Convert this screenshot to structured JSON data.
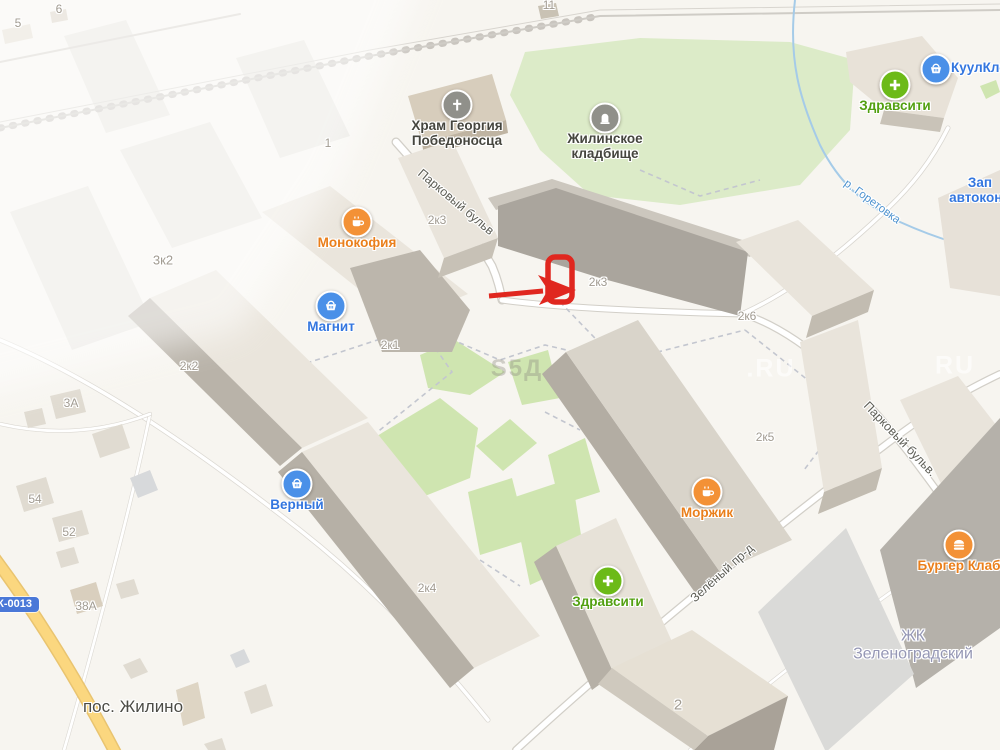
{
  "map": {
    "palette": {
      "land": "#f7f5f0",
      "green_courtyard": "#cfe5b0",
      "green_cemetery": "#dcebc8",
      "building_roof": "#eae5dc",
      "building_side_dark": "#b5afa5",
      "building_roof_dark": "#aaa59d",
      "poi_blue": "#3376df",
      "poi_orange": "#ea7f1b",
      "poi_green": "#53a011",
      "poi_gray": "#90908a",
      "annotation_red": "#e0271f",
      "river_blue": "#4f93cf"
    },
    "pois": [
      {
        "id": "hram-georgiya",
        "icon": "church",
        "x": 457,
        "y": 105,
        "circle": "#90908a",
        "text_color": "#45453e",
        "lines": [
          "Храм Георгия",
          "Победоносца"
        ]
      },
      {
        "id": "zhilinskoe-kladbishche",
        "icon": "grave",
        "x": 605,
        "y": 118,
        "circle": "#90908a",
        "text_color": "#45453e",
        "lines": [
          "Жилинское",
          "кладбище"
        ]
      },
      {
        "id": "monokofiya",
        "icon": "coffee",
        "x": 357,
        "y": 222,
        "circle": "#f39136",
        "text_color": "#ea7f1b",
        "lines": [
          "Монокофия"
        ]
      },
      {
        "id": "magnit",
        "icon": "basket",
        "x": 331,
        "y": 306,
        "circle": "#4a90e8",
        "text_color": "#3376df",
        "lines": [
          "Магнит"
        ]
      },
      {
        "id": "verny",
        "icon": "basket",
        "x": 297,
        "y": 484,
        "circle": "#4a90e8",
        "text_color": "#3376df",
        "lines": [
          "Верный"
        ]
      },
      {
        "id": "zdravsiti-south",
        "icon": "plus",
        "x": 608,
        "y": 581,
        "circle": "#6cba18",
        "text_color": "#53a011",
        "lines": [
          "Здравсити"
        ]
      },
      {
        "id": "zdravsiti-north",
        "icon": "plus",
        "x": 895,
        "y": 85,
        "circle": "#6cba18",
        "text_color": "#53a011",
        "lines": [
          "Здравсити"
        ]
      },
      {
        "id": "morzhik",
        "icon": "coffee",
        "x": 707,
        "y": 492,
        "circle": "#f39136",
        "text_color": "#ea7f1b",
        "lines": [
          "Моржик"
        ]
      },
      {
        "id": "burger-klab",
        "icon": "burger",
        "x": 959,
        "y": 545,
        "circle": "#f39136",
        "text_color": "#ea7f1b",
        "lines": [
          "Бургер Клаб"
        ]
      },
      {
        "id": "kuulklever",
        "icon": "basket",
        "x": 936,
        "y": 69,
        "circle": "#4a90e8",
        "text_color": "#3376df",
        "label_side": true,
        "lines": [
          "КуулКле"
        ]
      },
      {
        "id": "avtokond",
        "icon": null,
        "x": 980,
        "y": 190,
        "text_color": "#3376df",
        "lines": [
          "Зап",
          "автоконд"
        ]
      }
    ],
    "house_numbers": [
      {
        "text": "5",
        "x": 18,
        "y": 23
      },
      {
        "text": "6",
        "x": 59,
        "y": 9
      },
      {
        "text": "11",
        "x": 549,
        "y": 5
      },
      {
        "text": "1",
        "x": 328,
        "y": 143
      },
      {
        "text": "3к2",
        "x": 163,
        "y": 260,
        "size": 13
      },
      {
        "text": "2к3",
        "x": 437,
        "y": 220
      },
      {
        "text": "2к3",
        "x": 598,
        "y": 282
      },
      {
        "text": "2к1",
        "x": 390,
        "y": 345
      },
      {
        "text": "2к2",
        "x": 189,
        "y": 366
      },
      {
        "text": "2к6",
        "x": 747,
        "y": 316
      },
      {
        "text": "2к5",
        "x": 765,
        "y": 437
      },
      {
        "text": "2к4",
        "x": 427,
        "y": 588
      },
      {
        "text": "3А",
        "x": 71,
        "y": 403
      },
      {
        "text": "54",
        "x": 35,
        "y": 499
      },
      {
        "text": "52",
        "x": 69,
        "y": 532
      },
      {
        "text": "38А",
        "x": 86,
        "y": 606
      },
      {
        "text": "2",
        "x": 678,
        "y": 705,
        "size": 15
      }
    ],
    "streets": [
      {
        "text": "Парковый бульв",
        "x": 456,
        "y": 202,
        "angle": 40
      },
      {
        "text": "Парковый бульв.",
        "x": 900,
        "y": 439,
        "angle": 46
      },
      {
        "text": "Зелёный пр-д",
        "x": 722,
        "y": 573,
        "angle": -42
      }
    ],
    "river_label": {
      "text": "р. Горетовка",
      "x": 872,
      "y": 202,
      "angle": 36
    },
    "places": [
      {
        "id": "pos-zhilino",
        "lines": [
          "пос. Жилино"
        ],
        "x": 133,
        "y": 707,
        "size": 17,
        "color": "#4c4c46",
        "bold": false
      },
      {
        "id": "zhk-zelenogradsky",
        "lines": [
          "ЖК",
          "Зеленоградский"
        ],
        "x": 913,
        "y": 646,
        "size": 16,
        "color": "#9597b5",
        "bold": false
      }
    ],
    "road_badge": {
      "text": "5К-0013"
    },
    "watermarks": [
      {
        "text": "S5Д",
        "x": 517,
        "y": 369,
        "style": "dark"
      },
      {
        "text": ".RU",
        "x": 771,
        "y": 369,
        "style": "light"
      },
      {
        "text": "RU",
        "x": 955,
        "y": 366,
        "style": "light"
      }
    ]
  }
}
